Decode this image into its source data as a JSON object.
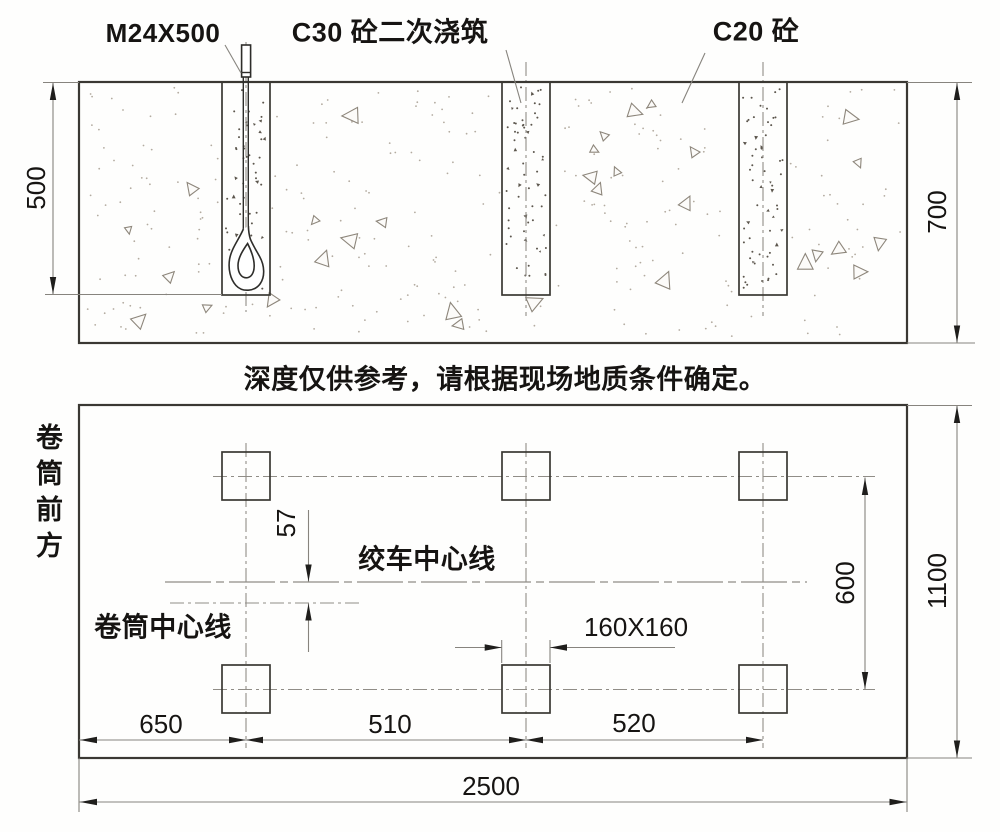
{
  "section_view": {
    "label_bolt": "M24X500",
    "label_c30": "C30 砼二次浇筑",
    "label_c20": "C20 砼",
    "dim_pocket_depth": "500",
    "dim_total_depth": "700"
  },
  "note": "深度仅供参考，请根据现场地质条件确定。",
  "plan_view": {
    "label_front": "卷筒前方",
    "label_winch_centerline": "绞车中心线",
    "label_drum_centerline": "卷筒中心线",
    "dim_centerline_offset": "57",
    "dim_hole": "160X160",
    "dim_row_spacing": "600",
    "dim_height": "1100",
    "dim_col_1": "650",
    "dim_col_2": "510",
    "dim_col_3": "520",
    "dim_total_width": "2500"
  },
  "colors": {
    "object_line": "#3a3833",
    "dim_line": "#87847e",
    "arrow": "#1f1e1c",
    "stipple": "#b3aba0",
    "aggregate": "#8d867b",
    "pocket_speck": "#5c564d"
  }
}
